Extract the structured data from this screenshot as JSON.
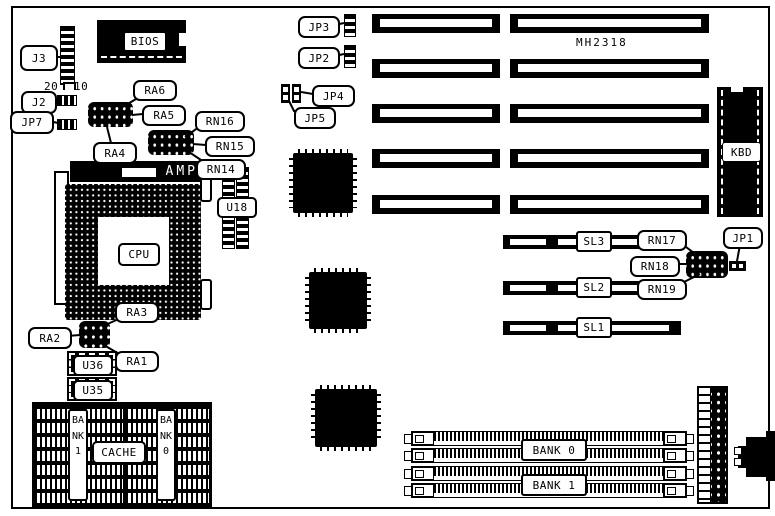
{
  "board": {
    "model": "MH2318"
  },
  "connector_numbers": {
    "left": "20",
    "right": "10"
  },
  "callouts": {
    "j3": "J3",
    "j2": "J2",
    "jp7": "JP7",
    "jp3": "JP3",
    "jp2": "JP2",
    "jp4": "JP4",
    "jp5": "JP5",
    "jp1": "JP1",
    "ra6": "RA6",
    "ra5": "RA5",
    "ra4": "RA4",
    "ra3": "RA3",
    "ra2": "RA2",
    "ra1": "RA1",
    "rn16": "RN16",
    "rn15": "RN15",
    "rn14": "RN14",
    "rn17": "RN17",
    "rn18": "RN18",
    "rn19": "RN19"
  },
  "chips": {
    "bios": "BIOS",
    "cpu": "CPU",
    "socket_brand": "AMP",
    "u18": "U18",
    "u36": "U36",
    "u35": "U35",
    "kbd": "KBD"
  },
  "slots": {
    "sl3": "SL3",
    "sl2": "SL2",
    "sl1": "SL1"
  },
  "memory": {
    "cache_label": "CACHE",
    "cache_bank_left": "BANK 1",
    "cache_bank_right": "BANK 0",
    "simm_bank_top": "BANK 0",
    "simm_bank_bottom": "BANK 1"
  },
  "colors": {
    "ink": "#000000",
    "paper": "#ffffff"
  }
}
